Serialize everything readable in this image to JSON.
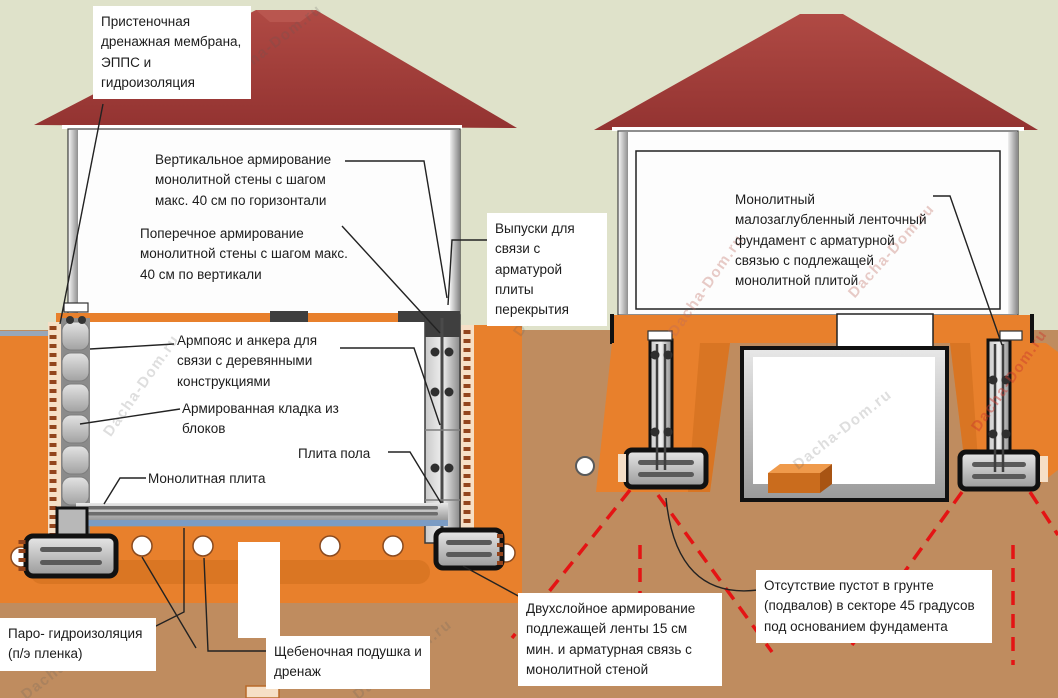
{
  "diagram": {
    "subject": "Схема монолитных фундаментов дома: заглубленный подвал и малозаглубленный ленточный фундамент",
    "watermark": {
      "text": "Dacha-Dom.ru"
    },
    "labels": {
      "wall_membrane": "Пристеночная дренажная мембрана, ЭППС и гидроизоляция",
      "vertical_reinforcement": "Вертикальное армирование монолитной стены  с шагом макс. 40 см по горизонтали",
      "transverse_reinforcement": "Поперечное армирование монолитной стены  с шагом макс. 40 см по вертикали",
      "slab_rebar_outlets": "Выпуски для связи с арматурой плиты перекрытия",
      "armo_belt": "Армпояс и анкера для связи с деревянными конструкциями",
      "reinforced_masonry": "Армированная кладка из блоков",
      "floor_slab": "Плита пола",
      "monolithic_slab": "Монолитная плита",
      "vapor_waterproofing": "Паро- гидроизоляция (п/э пленка)",
      "gravel_cushion": "Щебеночная подушка и дренаж",
      "two_layer_reinforcement": "Двухслойное армирование подлежащей ленты 15 см мин. и арматурная связь с монолитной стеной",
      "no_voids_sector": "Отсутствие пустот в грунте (подвалов) в секторе 45 градусов под основанием фундамента",
      "strip_foundation": "Монолитный малозаглубленный ленточный фундамент с арматурной связью с подлежащей монолитной плитой"
    },
    "colors": {
      "sky": "#dfe2ca",
      "soil": "#bf8c5f",
      "backfill_orange": "#e8802c",
      "backfill_orange_dark": "#d3701f",
      "roof_red": "#9d3836",
      "concrete_gray_light": "#d9d9d9",
      "concrete_gray_dark": "#9a9a9a",
      "membrane_peach": "#f6dfc6",
      "membrane_dots_brown": "#93441c",
      "slab_blue": "#7b9cc4",
      "danger_dashed_red": "#e41414",
      "outline_black": "#111111",
      "label_background": "#ffffff"
    }
  }
}
